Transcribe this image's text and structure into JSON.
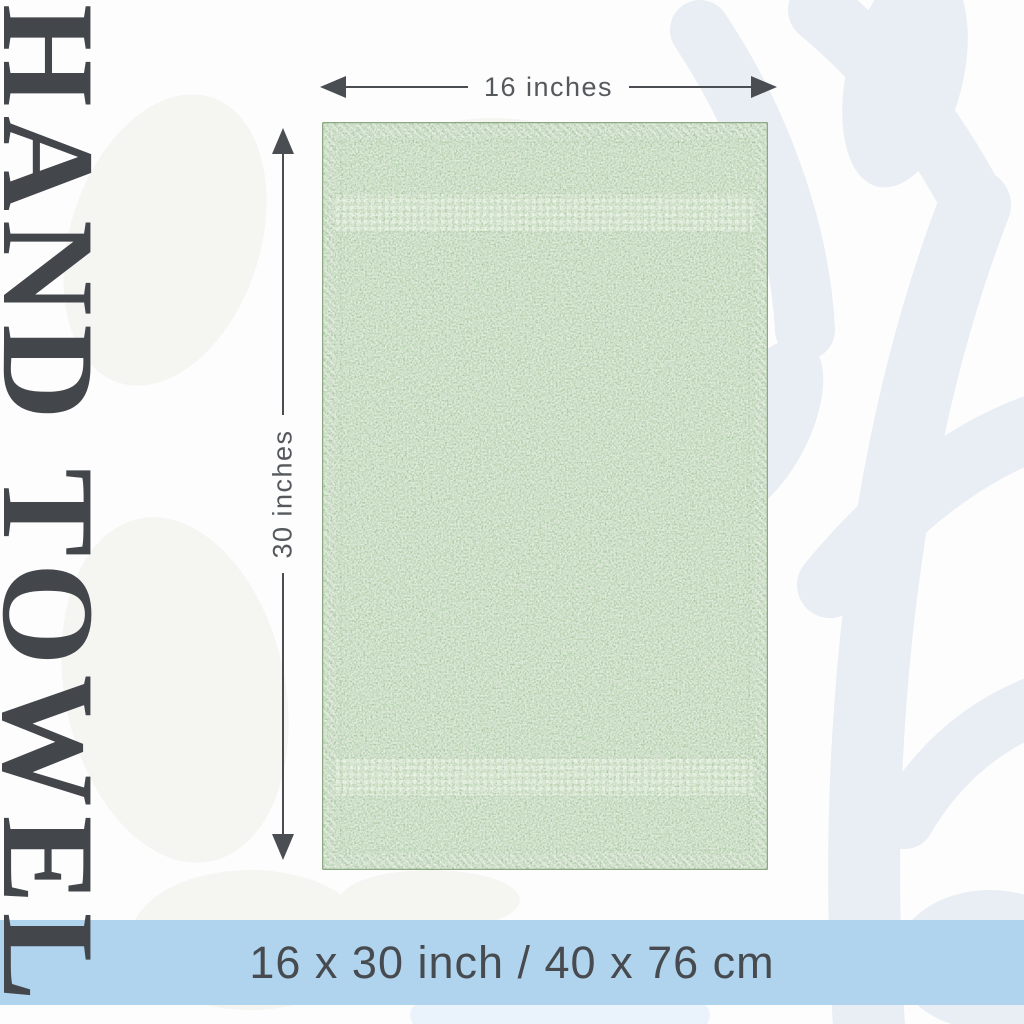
{
  "title": {
    "text": "HAND TOWEL"
  },
  "dimension_width": {
    "label": "16 inches"
  },
  "dimension_height": {
    "label": "30 inches"
  },
  "size_banner": {
    "text": "16 x 30 inch / 40 x 76 cm"
  },
  "colors": {
    "page_bg": "#fdfdfd",
    "title_text": "#43474c",
    "dimension_text": "#55585c",
    "arrow": "#4a4d51",
    "towel_base": "#a9c8a0",
    "towel_band": "#b6d1ab",
    "towel_hatch": "#a3c29a",
    "towel_edge": "#8ca983",
    "banner_bg": "#b0d4ee",
    "banner_text": "#474b50",
    "pattern_blue": "#e9edf4",
    "pattern_gray": "#f5f5f2",
    "pattern_blue_light": "#eaf3fb"
  }
}
